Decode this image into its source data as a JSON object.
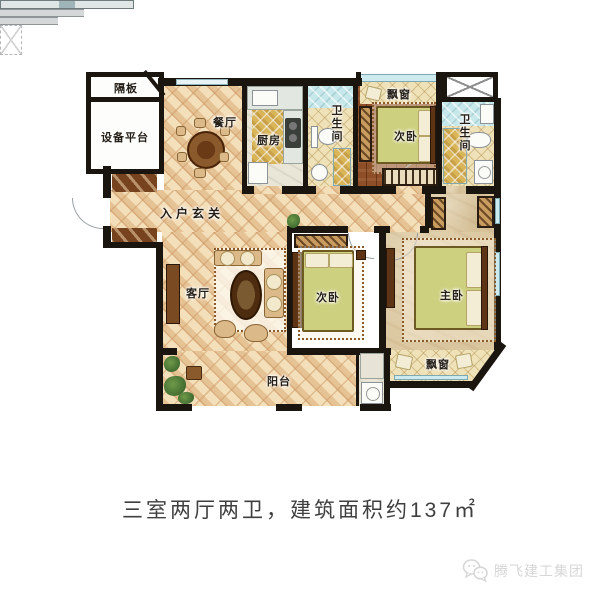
{
  "type": "apartment-floor-plan",
  "labels": {
    "geban": "隔板",
    "shebeipingtai": "设备平台",
    "canting": "餐厅",
    "chufang": "厨房",
    "weishengjian_1": "卫生间",
    "piaochuang_1": "飘窗",
    "ciwo_1": "次卧",
    "weishengjian_2": "卫生间",
    "ruhuxuanguan": "入户玄关",
    "keting": "客厅",
    "ciwo_2": "次卧",
    "zhuwo": "主卧",
    "yangtai": "阳台",
    "piaochuang_2": "飘窗"
  },
  "caption": {
    "text": "三室两厅两卫，建筑面积约137㎡"
  },
  "watermark": {
    "brand": "腾飞建工集团",
    "icon": "chat-bubbles-icon"
  },
  "palette": {
    "wall": "#1b1510",
    "tile_floor": "#eed7ae",
    "tile_stripe": "#cd9864",
    "wood_floor": "#8d4e28",
    "master_floor": "#dcc9a2",
    "kitchen_rug_gold": "#d9b557",
    "bath_tile_cyan": "#c7e8ea",
    "blanket_green": "#cdd07e",
    "caption_text": "#3f3f3f",
    "watermark_gray": "#d7d7d7"
  }
}
